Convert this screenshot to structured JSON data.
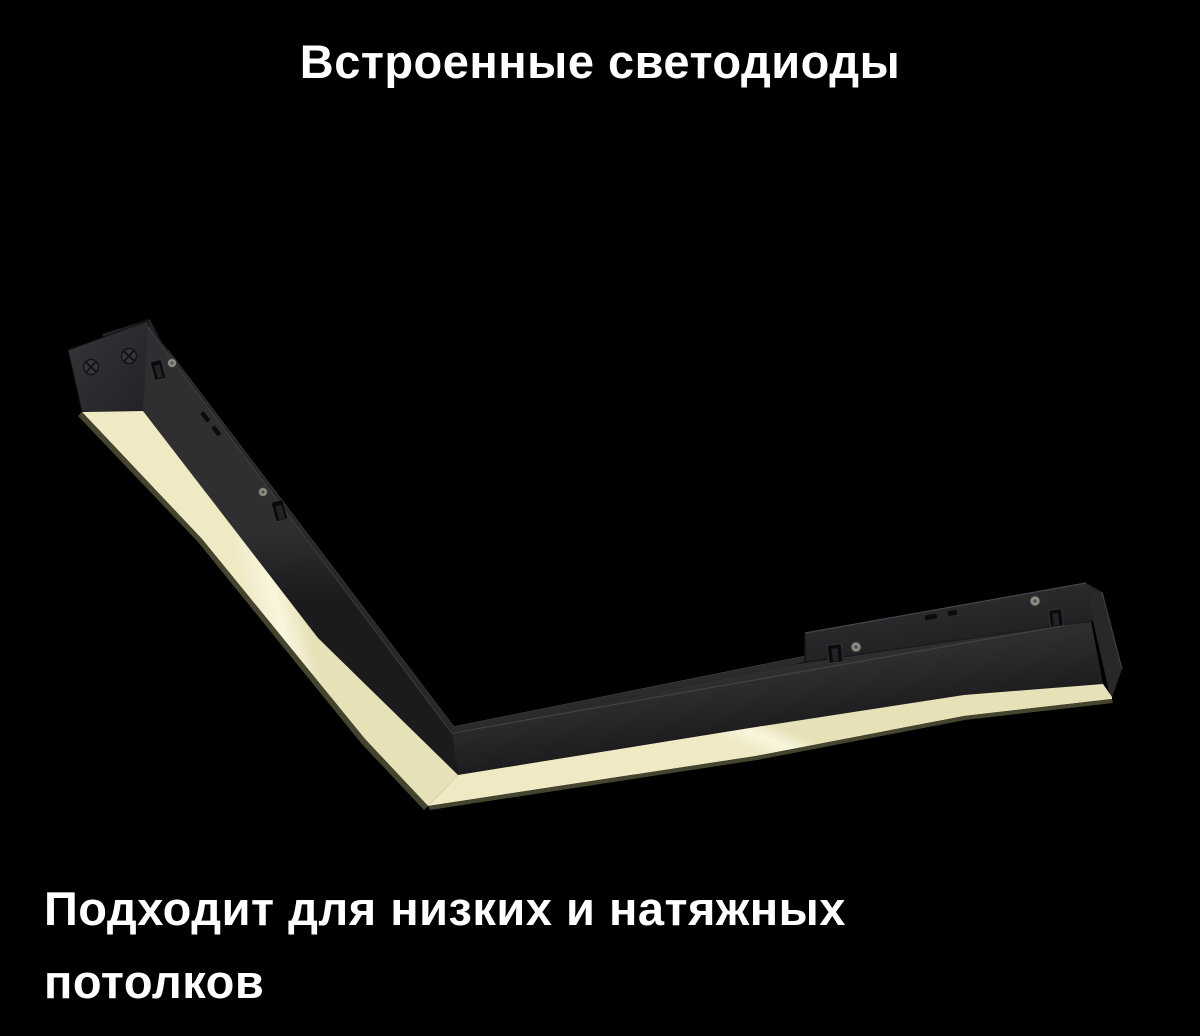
{
  "page": {
    "background_color": "#000000",
    "description": "Product slide: V-shaped corner magnetic track linear LED luminaire on a black background"
  },
  "title": {
    "text": "Встроенные светодиоды",
    "color": "#ffffff"
  },
  "caption": {
    "line1": "Подходит для низких и натяжных",
    "line2": "потолков",
    "color": "#ffffff"
  },
  "fixture": {
    "name": "corner-led-track-light",
    "housing_color": "#232326",
    "housing_highlight_color": "#47474b",
    "top_face_color": "#28282b",
    "plate_color": "#26262a",
    "diffuser_color": "#f9f6de",
    "diffuser_shade_color": "#e7e1b8",
    "diffuser_outer_color": "#efe9c4",
    "diffuser_edge_color": "#45442f",
    "screw_silver_color": "#8f8f89",
    "clip_color": "#0b0b0c"
  }
}
